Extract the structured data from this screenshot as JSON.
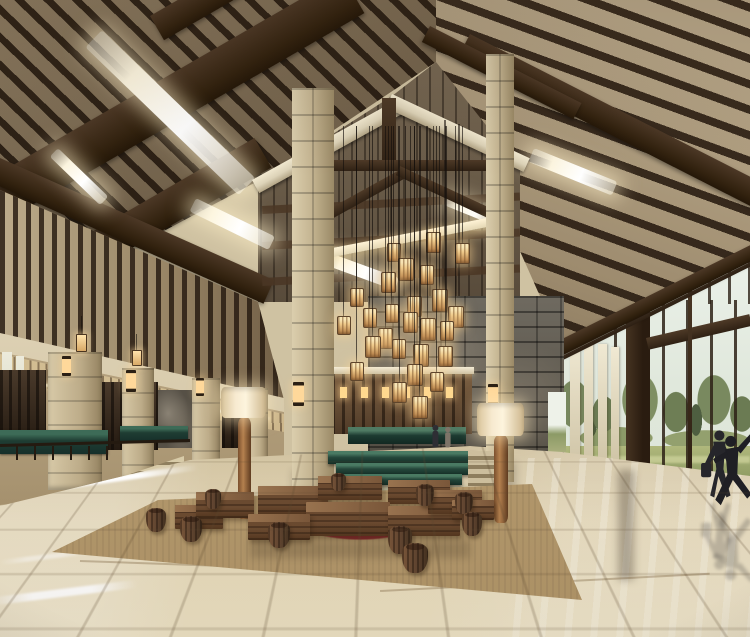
{
  "scene": {
    "type": "architectural-interior-rendering",
    "subject": "timber-frame resort hotel lobby",
    "description": "Double-height hotel lobby with dark exposed wood roof trusses and woven ceiling panels, linear skylights, a cluster of glowing box lanterns hanging on long cables in front of a grey stacked-stone wall, two tall limestone columns, a wood-slat reception wall with lit niches, green marble counters and a stepped water feature, low wooden block benches and barrel stools on a beige rug with maroon pattern, polished reflective marble floor, and full-height glazing on the right looking onto trees and lawn with two people walking.",
    "people_count": 4,
    "time_of_day": "daytime"
  },
  "palette": {
    "beam_dark": "#34251a",
    "beam_mid": "#4a3624",
    "panel": "#b3a284",
    "panel_dark": "#8d7d63",
    "cream": "#ddd3b8",
    "cream_bright": "#efe6cd",
    "glow": "#fdf6e0",
    "stone_light": "#c9bb9b",
    "graystone": "#6b655c",
    "wood_screen": "#35291e",
    "green_marble": "#24433a",
    "bench_wood": "#5d4029",
    "rug_tan": "#b2976b",
    "rug_red": "#8c2e30",
    "floor": "#d6c8a8",
    "sky": "#eef3ee",
    "tree": "#73855c",
    "lawn": "#9aa56e",
    "figure": "#26262b",
    "lantern_glow": "#f2d3a0"
  },
  "ceiling": {
    "skylights": [
      {
        "x": 102,
        "y": 30,
        "w": 213,
        "h": 24,
        "rot": 44
      },
      {
        "x": 58,
        "y": 148,
        "w": 70,
        "h": 12,
        "rot": 44
      },
      {
        "x": 196,
        "y": 198,
        "w": 88,
        "h": 15,
        "rot": 26
      },
      {
        "x": 322,
        "y": 250,
        "w": 82,
        "h": 13,
        "rot": 20
      },
      {
        "x": 534,
        "y": 148,
        "w": 90,
        "h": 15,
        "rot": 22
      },
      {
        "x": 448,
        "y": 196,
        "w": 54,
        "h": 10,
        "rot": 22
      }
    ]
  },
  "chandelier": {
    "cable_top": 126,
    "lantern_count": 26,
    "lanterns": [
      {
        "x": 426,
        "y": 232,
        "s": 1.0
      },
      {
        "x": 387,
        "y": 243,
        "s": 0.9
      },
      {
        "x": 455,
        "y": 243,
        "s": 1.0
      },
      {
        "x": 398,
        "y": 258,
        "s": 1.1
      },
      {
        "x": 420,
        "y": 265,
        "s": 0.95
      },
      {
        "x": 381,
        "y": 272,
        "s": 1.0
      },
      {
        "x": 350,
        "y": 288,
        "s": 0.9
      },
      {
        "x": 432,
        "y": 289,
        "s": 1.1
      },
      {
        "x": 407,
        "y": 296,
        "s": 1.0
      },
      {
        "x": 363,
        "y": 308,
        "s": 0.95
      },
      {
        "x": 448,
        "y": 306,
        "s": 1.05
      },
      {
        "x": 385,
        "y": 304,
        "s": 0.9
      },
      {
        "x": 403,
        "y": 312,
        "s": 1.0
      },
      {
        "x": 420,
        "y": 318,
        "s": 1.1
      },
      {
        "x": 440,
        "y": 321,
        "s": 0.95
      },
      {
        "x": 337,
        "y": 316,
        "s": 0.9
      },
      {
        "x": 378,
        "y": 328,
        "s": 1.0
      },
      {
        "x": 365,
        "y": 336,
        "s": 1.05
      },
      {
        "x": 392,
        "y": 339,
        "s": 0.95
      },
      {
        "x": 413,
        "y": 344,
        "s": 1.1
      },
      {
        "x": 438,
        "y": 346,
        "s": 1.0
      },
      {
        "x": 350,
        "y": 362,
        "s": 0.9
      },
      {
        "x": 407,
        "y": 364,
        "s": 1.05
      },
      {
        "x": 430,
        "y": 372,
        "s": 0.95
      },
      {
        "x": 392,
        "y": 382,
        "s": 1.0
      },
      {
        "x": 412,
        "y": 396,
        "s": 1.1
      }
    ]
  },
  "lighting": {
    "sconces": [
      {
        "x": 293,
        "y": 382,
        "w": 11,
        "h": 24
      },
      {
        "x": 488,
        "y": 384,
        "w": 10,
        "h": 22
      },
      {
        "x": 126,
        "y": 370,
        "w": 10,
        "h": 22
      },
      {
        "x": 196,
        "y": 378,
        "w": 8,
        "h": 18
      },
      {
        "x": 62,
        "y": 356,
        "w": 9,
        "h": 20
      }
    ],
    "pendants": [
      {
        "x": 76,
        "y": 334,
        "w": 9,
        "h": 16,
        "cord": 18
      },
      {
        "x": 132,
        "y": 350,
        "w": 8,
        "h": 14,
        "cord": 16
      }
    ],
    "floor_lamps": [
      {
        "shade": [
          221,
          387,
          45,
          31
        ],
        "base": [
          238,
          417,
          13,
          102
        ]
      },
      {
        "shade": [
          477,
          403,
          47,
          33
        ],
        "base": [
          494,
          435,
          14,
          88
        ]
      }
    ]
  },
  "reception": {
    "niches": [
      {
        "x": 340,
        "y": 387,
        "w": 7,
        "h": 11
      },
      {
        "x": 361,
        "y": 387,
        "w": 7,
        "h": 11
      },
      {
        "x": 382,
        "y": 387,
        "w": 7,
        "h": 11
      },
      {
        "x": 403,
        "y": 387,
        "w": 7,
        "h": 11
      },
      {
        "x": 424,
        "y": 387,
        "w": 7,
        "h": 11
      },
      {
        "x": 446,
        "y": 387,
        "w": 7,
        "h": 11
      }
    ]
  },
  "furniture": {
    "benches": [
      {
        "x": 175,
        "y": 505,
        "w": 48,
        "h": 24
      },
      {
        "x": 196,
        "y": 492,
        "w": 58,
        "h": 26
      },
      {
        "x": 258,
        "y": 486,
        "w": 70,
        "h": 30
      },
      {
        "x": 318,
        "y": 476,
        "w": 64,
        "h": 24
      },
      {
        "x": 388,
        "y": 480,
        "w": 62,
        "h": 24
      },
      {
        "x": 306,
        "y": 502,
        "w": 84,
        "h": 34
      },
      {
        "x": 388,
        "y": 506,
        "w": 72,
        "h": 30
      },
      {
        "x": 428,
        "y": 490,
        "w": 54,
        "h": 24
      },
      {
        "x": 248,
        "y": 514,
        "w": 62,
        "h": 26
      },
      {
        "x": 452,
        "y": 500,
        "w": 42,
        "h": 20
      }
    ],
    "stools": [
      {
        "x": 146,
        "y": 508,
        "w": 20,
        "h": 24
      },
      {
        "x": 180,
        "y": 516,
        "w": 22,
        "h": 26
      },
      {
        "x": 268,
        "y": 522,
        "w": 22,
        "h": 26
      },
      {
        "x": 388,
        "y": 526,
        "w": 24,
        "h": 28
      },
      {
        "x": 402,
        "y": 543,
        "w": 26,
        "h": 30
      },
      {
        "x": 416,
        "y": 484,
        "w": 18,
        "h": 22
      },
      {
        "x": 455,
        "y": 492,
        "w": 18,
        "h": 22
      },
      {
        "x": 462,
        "y": 512,
        "w": 20,
        "h": 24
      },
      {
        "x": 205,
        "y": 489,
        "w": 16,
        "h": 20
      },
      {
        "x": 331,
        "y": 473,
        "w": 15,
        "h": 18
      }
    ]
  },
  "figures": [
    {
      "pose": "walking-with-bag",
      "x": 698,
      "y": 428,
      "h": 74,
      "tint": "#26262b",
      "reflection": true
    },
    {
      "pose": "arm-raised",
      "x": 712,
      "y": 430,
      "h": 80,
      "tint": "#1f1f24",
      "reflection": true
    },
    {
      "pose": "standing",
      "x": 428,
      "y": 424,
      "h": 27,
      "tint": "#2e2e34",
      "reflection": false
    },
    {
      "pose": "standing",
      "x": 441,
      "y": 426,
      "h": 25,
      "tint": "#7d7468",
      "reflection": false
    }
  ]
}
